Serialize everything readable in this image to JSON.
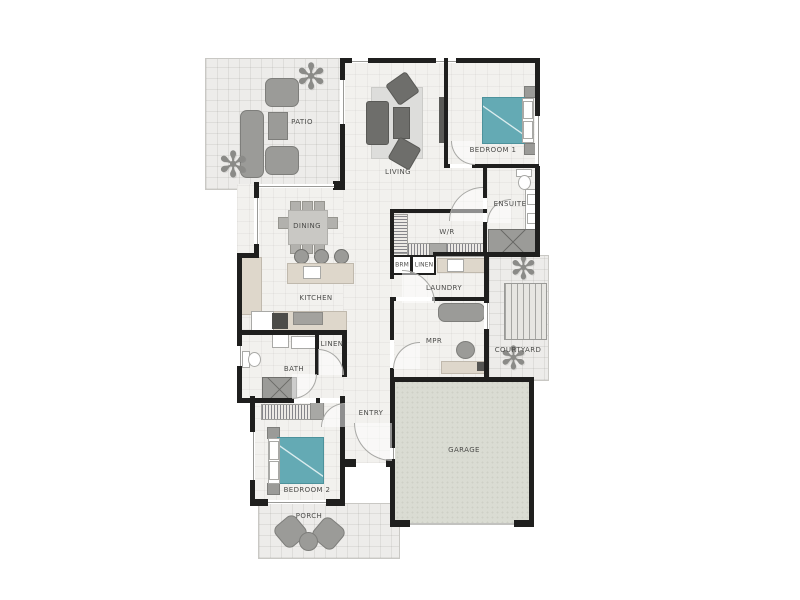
{
  "title": "Single storey house floor plan",
  "rooms": {
    "patio": {
      "label": "PATIO"
    },
    "living": {
      "label": "LIVING"
    },
    "bedroom1": {
      "label": "BEDROOM 1"
    },
    "ensuite": {
      "label": "ENSUITE"
    },
    "wir": {
      "label": "W/R"
    },
    "broom": {
      "label": "BRM"
    },
    "linen_laundry": {
      "label": "LINEN"
    },
    "laundry": {
      "label": "LAUNDRY"
    },
    "dining": {
      "label": "DINING"
    },
    "kitchen": {
      "label": "KITCHEN"
    },
    "mpr": {
      "label": "MPR"
    },
    "courtyard": {
      "label": "COURTYARD"
    },
    "bath": {
      "label": "BATH"
    },
    "linen_bath": {
      "label": "LINEN"
    },
    "entry": {
      "label": "ENTRY"
    },
    "garage": {
      "label": "GARAGE"
    },
    "bedroom2": {
      "label": "BEDROOM 2"
    },
    "porch": {
      "label": "PORCH"
    }
  },
  "icons": {
    "plant": "✻"
  },
  "colors": {
    "wall": "#1f1f1e",
    "bed_teal": "#64aab4",
    "garage_floor": "#dadcd3",
    "outdoor_floor": "#edecea",
    "interior_floor": "#f2f1ee",
    "furniture_gray": "#9b9b98",
    "furniture_dark": "#6e6e6b",
    "counter_beige": "#ded7cb"
  }
}
